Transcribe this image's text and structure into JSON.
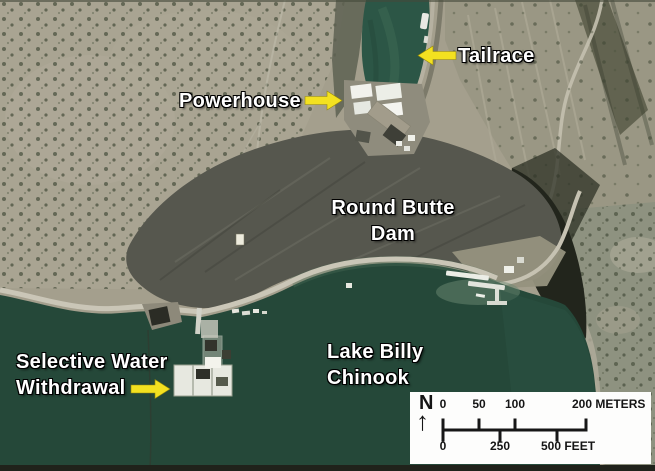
{
  "labels": {
    "powerhouse": "Powerhouse",
    "tailrace": "Tailrace",
    "dam_line1": "Round Butte",
    "dam_line2": "Dam",
    "lake_line1": "Lake Billy",
    "lake_line2": "Chinook",
    "sww_line1": "Selective Water",
    "sww_line2": "Withdrawal"
  },
  "scale_bar": {
    "north_label": "N",
    "north_arrow_icon": "↑",
    "meters": {
      "ticks": [
        "0",
        "50",
        "100"
      ],
      "end_label": "200 METERS"
    },
    "feet": {
      "ticks": [
        "0",
        "250"
      ],
      "end_label": "500 FEET"
    }
  },
  "colors": {
    "label_text": "#ffffff",
    "annotation_arrow": "#f3e120",
    "lake_water": "#254839",
    "tailrace_water": "#2c5646",
    "terrain_tan": "#a49f8d",
    "dam_gray": "#56574e",
    "cliff_shadow": "#22251c",
    "scale_box_bg": "#fdfdfc",
    "scale_text": "#151515"
  }
}
